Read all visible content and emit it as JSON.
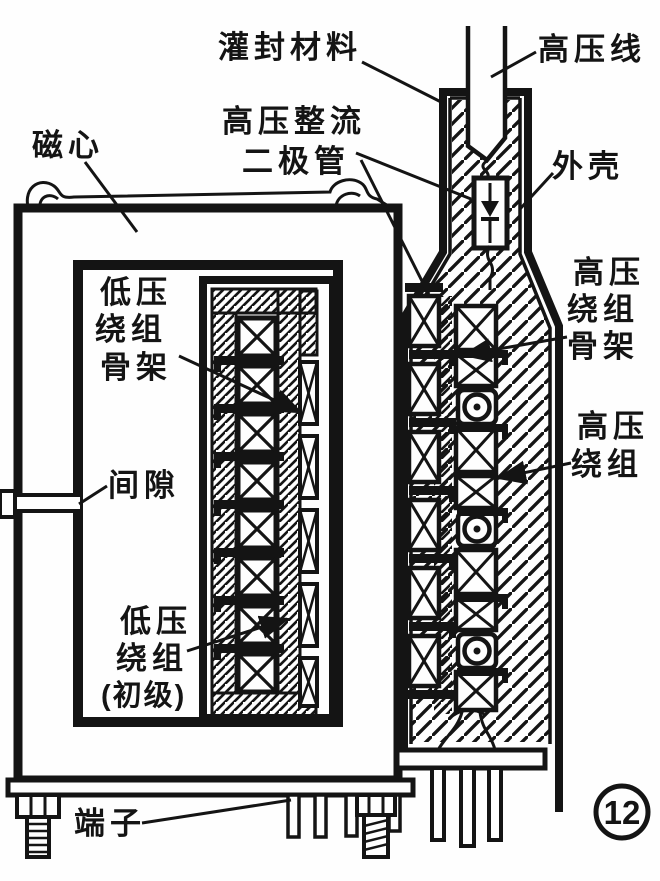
{
  "figure": {
    "ink_color": "#141414",
    "number": "12",
    "labels": {
      "core": "磁心",
      "potting": "灌封材料",
      "hv_wire": "高压线",
      "hv_rectifier_line1": "高压整流",
      "hv_rectifier_line2": "二极管",
      "case": "外壳",
      "lv_bobbin_line1": "低压",
      "lv_bobbin_line2": "绕组",
      "lv_bobbin_line3": "骨架",
      "gap": "间隙",
      "lv_winding_line1": "低压",
      "lv_winding_line2": "绕组",
      "lv_winding_line3": "(初级)",
      "hv_bobbin_line1": "高压",
      "hv_bobbin_line2": "绕组",
      "hv_bobbin_line3": "骨架",
      "hv_winding_line1": "高压",
      "hv_winding_line2": "绕组",
      "terminal": "端子"
    }
  }
}
